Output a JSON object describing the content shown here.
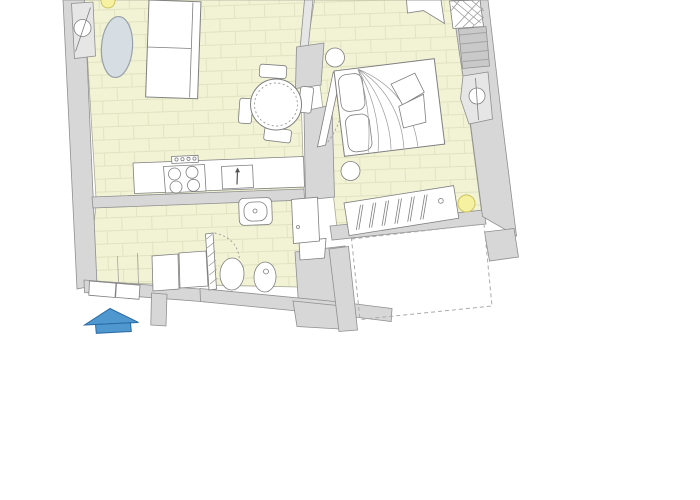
{
  "title": "apartment-floor-plan",
  "colors": {
    "background": "#ffffff",
    "floor": "#f2f3d5",
    "floor_line": "#e1e2c0",
    "floor_edge": "#a9a996",
    "wall": "#d7d7d7",
    "wall_edge": "#8f8f8f",
    "fixture_fill": "#ffffff",
    "fixture_outline": "#7f7f7f",
    "soft_line": "#9a9a9a",
    "window_fill": "#e6e6e6",
    "window_stripe": "#a3a3a3",
    "rug_fill": "#d6dee4",
    "rug_outline": "#97a1a8",
    "accent_yellow": "#f6f1a0",
    "accent_yellow_edge": "#cdc45f",
    "accent_blue": "#4f97cf",
    "accent_blue_edge": "#2a6aa5",
    "swing_dotted": "#9a9a9a",
    "dashed_outline": "#ababab",
    "hatch": "#9a9a9a"
  },
  "fixtures": {
    "living_room": [
      "sofa",
      "oval-rug",
      "dining-table",
      "dining-chairs-x4",
      "ceiling-light"
    ],
    "kitchen": [
      "counter",
      "stove-4-burners",
      "control-strip",
      "kitchen-sink"
    ],
    "bathroom": [
      "washbasin",
      "toilet",
      "bidet",
      "shower-unit",
      "washer-unit",
      "hatched-door-leaf"
    ],
    "bedroom": [
      "double-bed",
      "pillows-x2",
      "bedside-stool-x2",
      "radiator",
      "ceiling-light",
      "vent-shaft",
      "open-door-leaf"
    ],
    "openings": [
      "left-window",
      "striped-window",
      "pivot-window",
      "living-bedroom-door",
      "bedroom-door"
    ],
    "entrance": [
      "entry-arrow"
    ],
    "outside": [
      "dashed-void-area"
    ]
  }
}
